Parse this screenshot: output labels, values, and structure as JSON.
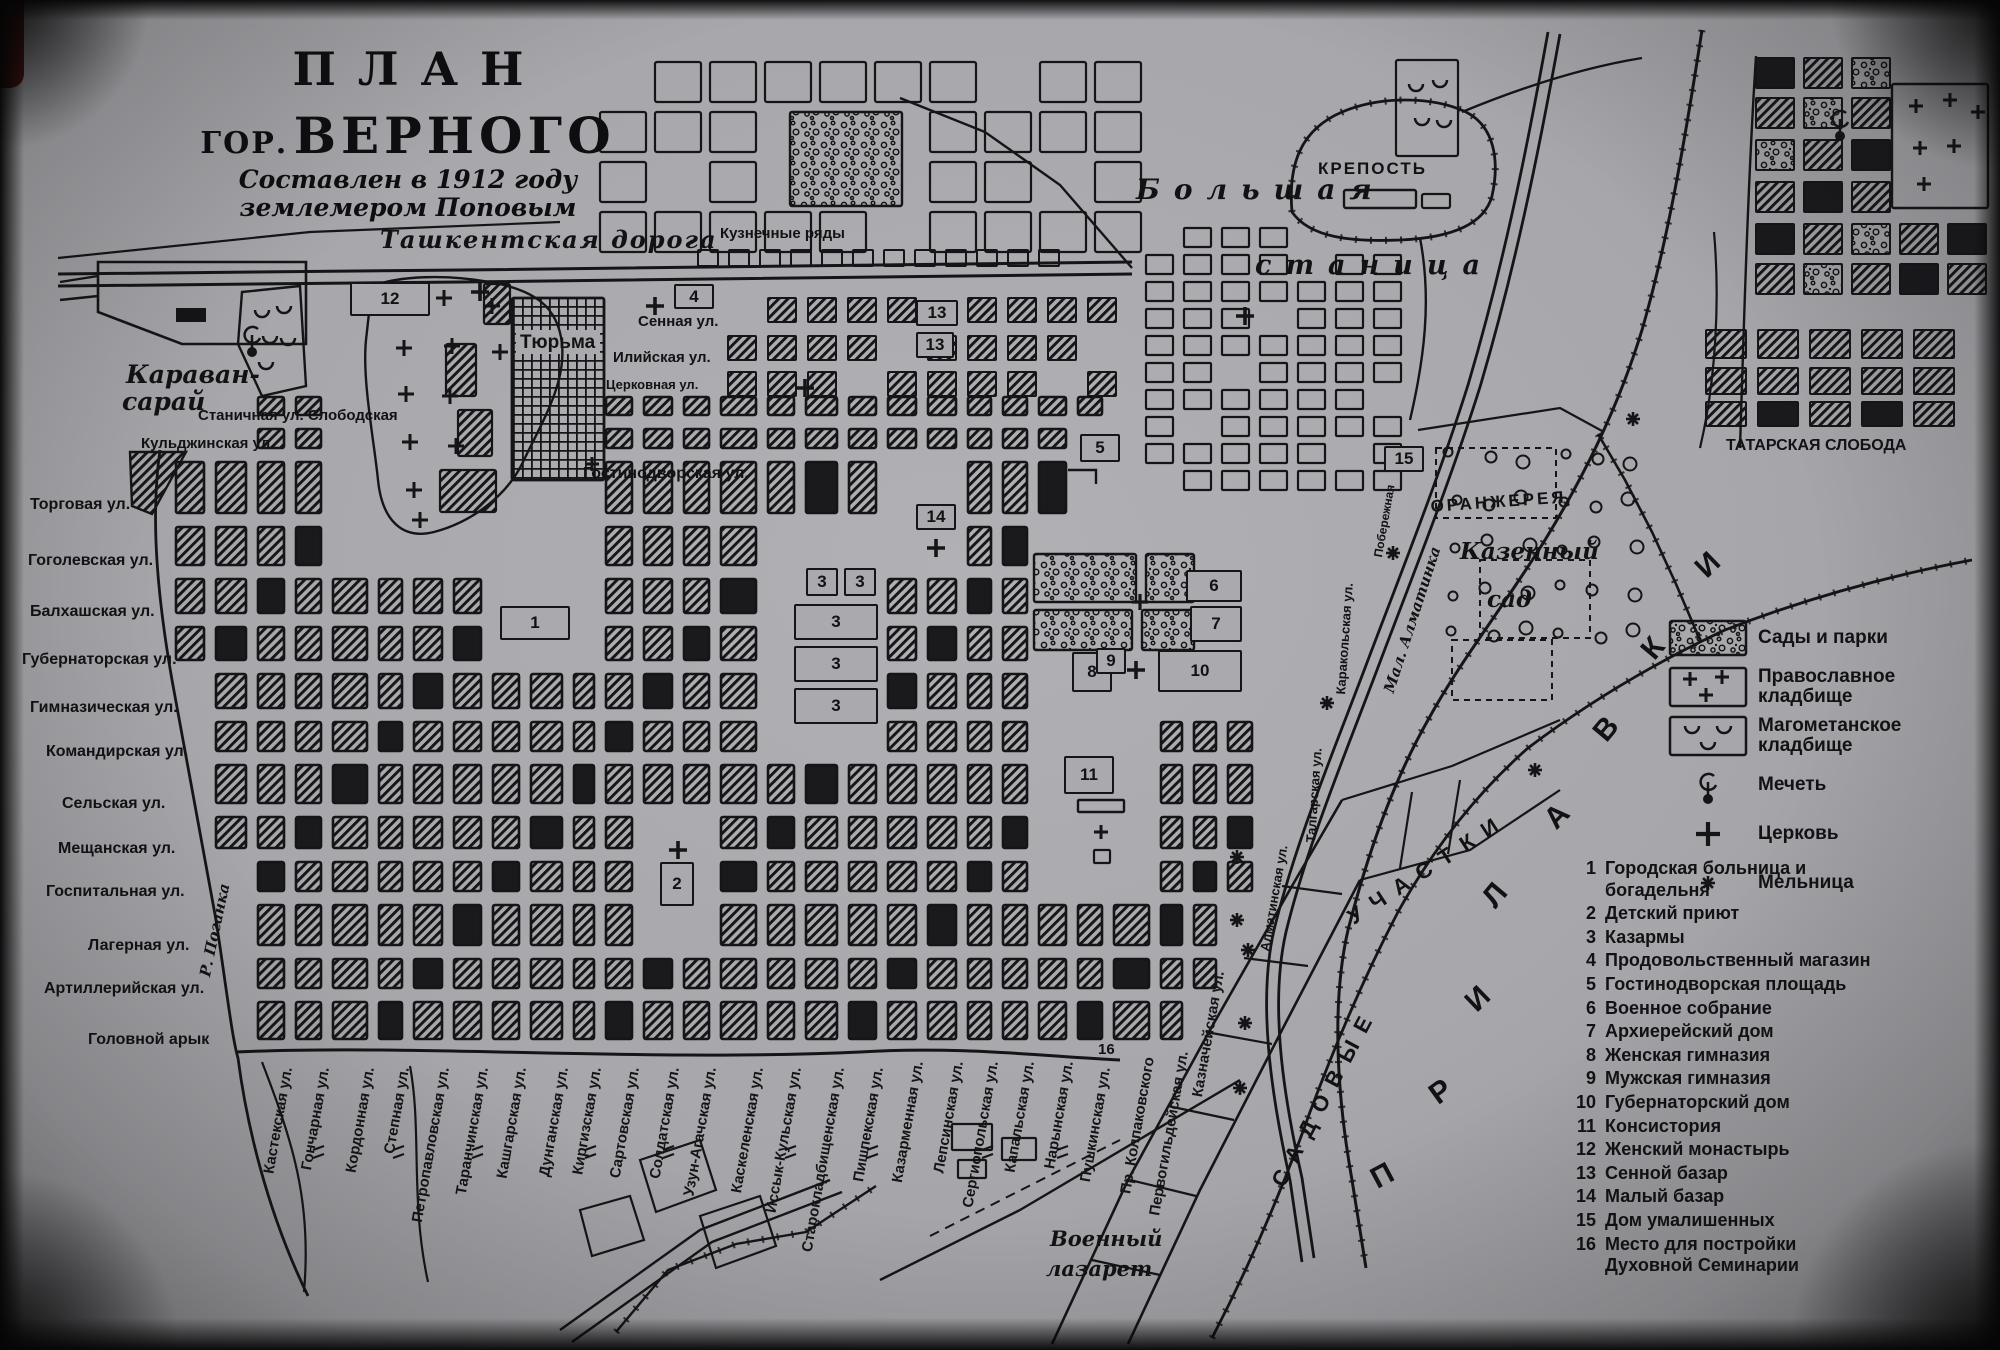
{
  "title": {
    "line1": "ПЛАН",
    "line2_prefix": "ГОР.",
    "line2_main": "ВЕРНОГО",
    "subtitle_line1": "Составлен в 1912 году",
    "subtitle_line2": "землемером Поповым"
  },
  "colors": {
    "paper": "#aaaaae",
    "ink": "#151517"
  },
  "legend": {
    "items": [
      {
        "type": "parks",
        "label": "Сады и парки"
      },
      {
        "type": "orthodox-cemetery",
        "label": "Православное кладбище"
      },
      {
        "type": "muslim-cemetery",
        "label": "Магометанское кладбище"
      },
      {
        "type": "mosque",
        "label": "Мечеть"
      },
      {
        "type": "church",
        "label": "Церковь"
      },
      {
        "type": "mill",
        "label": "Мельница"
      }
    ]
  },
  "index": {
    "items": [
      {
        "num": "1",
        "label": "Городская больница и богадельня"
      },
      {
        "num": "2",
        "label": "Детский приют"
      },
      {
        "num": "3",
        "label": "Казармы"
      },
      {
        "num": "4",
        "label": "Продовольственный магазин"
      },
      {
        "num": "5",
        "label": "Гостинодворская площадь"
      },
      {
        "num": "6",
        "label": "Военное собрание"
      },
      {
        "num": "7",
        "label": "Архиерейский дом"
      },
      {
        "num": "8",
        "label": "Женская гимназия"
      },
      {
        "num": "9",
        "label": "Мужская гимназия"
      },
      {
        "num": "10",
        "label": "Губернаторский дом"
      },
      {
        "num": "11",
        "label": "Консистория"
      },
      {
        "num": "12",
        "label": "Женский монастырь"
      },
      {
        "num": "13",
        "label": "Сенной базар"
      },
      {
        "num": "14",
        "label": "Малый базар"
      },
      {
        "num": "15",
        "label": "Дом умалишенных"
      },
      {
        "num": "16",
        "label": "Место для постройки Духовной Семинарии"
      }
    ]
  },
  "left_streets": [
    {
      "label": "Торговая ул.",
      "x": 30,
      "y": 497
    },
    {
      "label": "Гоголевская ул.",
      "x": 28,
      "y": 553
    },
    {
      "label": "Балхашская ул.",
      "x": 30,
      "y": 604
    },
    {
      "label": "Губернаторская ул.",
      "x": 22,
      "y": 652
    },
    {
      "label": "Гимназическая ул.",
      "x": 30,
      "y": 700
    },
    {
      "label": "Командирская ул.",
      "x": 46,
      "y": 744
    },
    {
      "label": "Сельская ул.",
      "x": 62,
      "y": 796
    },
    {
      "label": "Мещанская ул.",
      "x": 58,
      "y": 841
    },
    {
      "label": "Госпитальная ул.",
      "x": 46,
      "y": 884
    },
    {
      "label": "Лагерная ул.",
      "x": 88,
      "y": 938
    },
    {
      "label": "Артиллерийская ул.",
      "x": 44,
      "y": 981
    },
    {
      "label": "Головной арык",
      "x": 88,
      "y": 1032
    }
  ],
  "bottom_streets": [
    {
      "label": "Кастекская ул.",
      "x": 292,
      "y": 1068
    },
    {
      "label": "Гончарная ул.",
      "x": 329,
      "y": 1068
    },
    {
      "label": "Кордонная ул.",
      "x": 374,
      "y": 1068
    },
    {
      "label": "Степная ул.",
      "x": 409,
      "y": 1068
    },
    {
      "label": "Петропавловская ул.",
      "x": 449,
      "y": 1068
    },
    {
      "label": "Таранчинская ул.",
      "x": 488,
      "y": 1068
    },
    {
      "label": "Кашгарская ул.",
      "x": 526,
      "y": 1068
    },
    {
      "label": "Дунганская ул.",
      "x": 568,
      "y": 1068
    },
    {
      "label": "Киргизская ул.",
      "x": 601,
      "y": 1068
    },
    {
      "label": "Сартовская ул.",
      "x": 639,
      "y": 1068
    },
    {
      "label": "Солдатская ул.",
      "x": 679,
      "y": 1068
    },
    {
      "label": "Узун-Агачская ул.",
      "x": 716,
      "y": 1068
    },
    {
      "label": "Каскеленская ул.",
      "x": 763,
      "y": 1068
    },
    {
      "label": "Иссык-Кульская ул.",
      "x": 801,
      "y": 1068
    },
    {
      "label": "Старокладбищенская ул.",
      "x": 844,
      "y": 1068
    },
    {
      "label": "Пишпекская ул.",
      "x": 883,
      "y": 1068
    },
    {
      "label": "Казарменная ул.",
      "x": 923,
      "y": 1062
    },
    {
      "label": "Лепсинская ул.",
      "x": 963,
      "y": 1062
    },
    {
      "label": "Сергиопольская ул.",
      "x": 998,
      "y": 1062
    },
    {
      "label": "Капальская ул.",
      "x": 1034,
      "y": 1062
    },
    {
      "label": "Нарынская ул.",
      "x": 1073,
      "y": 1062
    },
    {
      "label": "Пушкинская ул.",
      "x": 1110,
      "y": 1068
    },
    {
      "label": "Пр. Колпаковского",
      "x": 1154,
      "y": 1058
    },
    {
      "label": "Первогильдейская ул.",
      "x": 1188,
      "y": 1052
    },
    {
      "label": "Казначейская ул.",
      "x": 1224,
      "y": 972
    }
  ],
  "map_labels": [
    {
      "text": "Караван-",
      "x": 126,
      "y": 362,
      "s": 25,
      "b": 1,
      "i": 1
    },
    {
      "text": "сарай",
      "x": 122,
      "y": 389,
      "s": 25,
      "b": 1,
      "i": 1
    },
    {
      "text": "Ташкентская дорога",
      "x": 380,
      "y": 228,
      "s": 24,
      "b": 1,
      "i": 1,
      "ls": 2
    },
    {
      "text": "Кузнечные ряды",
      "x": 720,
      "y": 226,
      "s": 15,
      "b": 1
    },
    {
      "text": "Большая",
      "x": 1136,
      "y": 176,
      "s": 28,
      "b": 1,
      "i": 1,
      "ls": 14
    },
    {
      "text": "станица",
      "x": 1255,
      "y": 252,
      "s": 27,
      "b": 1,
      "i": 1,
      "ls": 14
    },
    {
      "text": "КРЕПОСТЬ",
      "x": 1318,
      "y": 160,
      "s": 17,
      "b": 1,
      "ls": 2
    },
    {
      "text": "ТАТАРСКАЯ СЛОБОДА",
      "x": 1726,
      "y": 438,
      "s": 16,
      "b": 1
    },
    {
      "text": "ОРАНЖЕРЕЯ",
      "x": 1430,
      "y": 498,
      "s": 17,
      "b": 1,
      "ls": 3,
      "rot": -4
    },
    {
      "text": "Казенный",
      "x": 1460,
      "y": 540,
      "s": 23,
      "b": 1,
      "i": 1
    },
    {
      "text": "сад",
      "x": 1487,
      "y": 588,
      "s": 23,
      "b": 1,
      "i": 1
    },
    {
      "text": "Тюрьма",
      "x": 520,
      "y": 333,
      "s": 19,
      "b": 1
    },
    {
      "text": "Сенная ул.",
      "x": 638,
      "y": 314,
      "s": 15,
      "b": 1
    },
    {
      "text": "Илийская ул.",
      "x": 613,
      "y": 350,
      "s": 15,
      "b": 1
    },
    {
      "text": "Церковная ул.",
      "x": 606,
      "y": 378,
      "s": 13,
      "b": 1
    },
    {
      "text": "Гостинодворская ул.",
      "x": 583,
      "y": 466,
      "s": 16,
      "b": 1
    },
    {
      "text": "Станичная ул. Слободская",
      "x": 198,
      "y": 408,
      "s": 15,
      "b": 1
    },
    {
      "text": "Кульджинская ул.",
      "x": 141,
      "y": 436,
      "s": 15,
      "b": 1
    },
    {
      "text": "Военный",
      "x": 1050,
      "y": 1228,
      "s": 21,
      "b": 1,
      "i": 1
    },
    {
      "text": "лазарет",
      "x": 1046,
      "y": 1258,
      "s": 21,
      "b": 1,
      "i": 1
    },
    {
      "text": "16",
      "x": 1098,
      "y": 1042,
      "s": 15,
      "b": 1
    },
    {
      "text": "Р. Поганка",
      "x": 198,
      "y": 975,
      "s": 15,
      "b": 1,
      "i": 1,
      "rot": -78
    },
    {
      "text": "Мал. Алматинка",
      "x": 1382,
      "y": 690,
      "s": 15,
      "b": 1,
      "i": 1,
      "rot": -72
    },
    {
      "text": "Побережная",
      "x": 1372,
      "y": 556,
      "s": 12,
      "b": 1,
      "rot": -80
    },
    {
      "text": "Каракольская ул.",
      "x": 1334,
      "y": 694,
      "s": 13,
      "b": 1,
      "rot": -86
    },
    {
      "text": "Талгарская ул.",
      "x": 1304,
      "y": 842,
      "s": 13,
      "b": 1,
      "rot": -86
    },
    {
      "text": "Алматинская ул.",
      "x": 1258,
      "y": 950,
      "s": 13,
      "b": 1,
      "rot": -80
    },
    {
      "text": "САДОВЫЕ",
      "x": 1268,
      "y": 1180,
      "s": 22,
      "b": 1,
      "ls": 12,
      "rot": -62
    },
    {
      "text": "УЧАСТКИ",
      "x": 1344,
      "y": 910,
      "s": 22,
      "b": 1,
      "ls": 12,
      "rot": -33
    }
  ],
  "markers": [
    {
      "n": "12",
      "x": 350,
      "y": 282,
      "w": 80,
      "h": 34
    },
    {
      "n": "4",
      "x": 674,
      "y": 284,
      "w": 40,
      "h": 25
    },
    {
      "n": "13",
      "x": 916,
      "y": 300,
      "w": 42,
      "h": 26
    },
    {
      "n": "13",
      "x": 916,
      "y": 332,
      "w": 38,
      "h": 26
    },
    {
      "n": "5",
      "x": 1080,
      "y": 434,
      "w": 40,
      "h": 28
    },
    {
      "n": "14",
      "x": 916,
      "y": 504,
      "w": 40,
      "h": 26
    },
    {
      "n": "15",
      "x": 1384,
      "y": 446,
      "w": 40,
      "h": 26
    },
    {
      "n": "1",
      "x": 500,
      "y": 606,
      "w": 70,
      "h": 34
    },
    {
      "n": "3",
      "x": 806,
      "y": 568,
      "w": 32,
      "h": 28
    },
    {
      "n": "3",
      "x": 844,
      "y": 568,
      "w": 32,
      "h": 28
    },
    {
      "n": "3",
      "x": 794,
      "y": 604,
      "w": 84,
      "h": 36
    },
    {
      "n": "3",
      "x": 794,
      "y": 646,
      "w": 84,
      "h": 36
    },
    {
      "n": "3",
      "x": 794,
      "y": 688,
      "w": 84,
      "h": 36
    },
    {
      "n": "6",
      "x": 1186,
      "y": 570,
      "w": 56,
      "h": 32
    },
    {
      "n": "7",
      "x": 1190,
      "y": 606,
      "w": 52,
      "h": 36
    },
    {
      "n": "8",
      "x": 1072,
      "y": 652,
      "w": 40,
      "h": 40
    },
    {
      "n": "9",
      "x": 1096,
      "y": 648,
      "w": 30,
      "h": 26
    },
    {
      "n": "10",
      "x": 1158,
      "y": 650,
      "w": 84,
      "h": 42
    },
    {
      "n": "11",
      "x": 1064,
      "y": 756,
      "w": 50,
      "h": 38
    },
    {
      "n": "2",
      "x": 660,
      "y": 862,
      "w": 34,
      "h": 44
    }
  ],
  "prilavki": {
    "word": "ПРИЛАВКИ",
    "letters": [
      {
        "ch": "П",
        "x": 1366,
        "y": 1168,
        "rot": -28
      },
      {
        "ch": "Р",
        "x": 1424,
        "y": 1086,
        "rot": -36
      },
      {
        "ch": "И",
        "x": 1460,
        "y": 996,
        "rot": -44
      },
      {
        "ch": "Л",
        "x": 1477,
        "y": 894,
        "rot": -50
      },
      {
        "ch": "А",
        "x": 1539,
        "y": 814,
        "rot": -46
      },
      {
        "ch": "В",
        "x": 1588,
        "y": 728,
        "rot": -50
      },
      {
        "ch": "К",
        "x": 1636,
        "y": 646,
        "rot": -50
      },
      {
        "ch": "И",
        "x": 1690,
        "y": 562,
        "rot": -44
      }
    ]
  }
}
